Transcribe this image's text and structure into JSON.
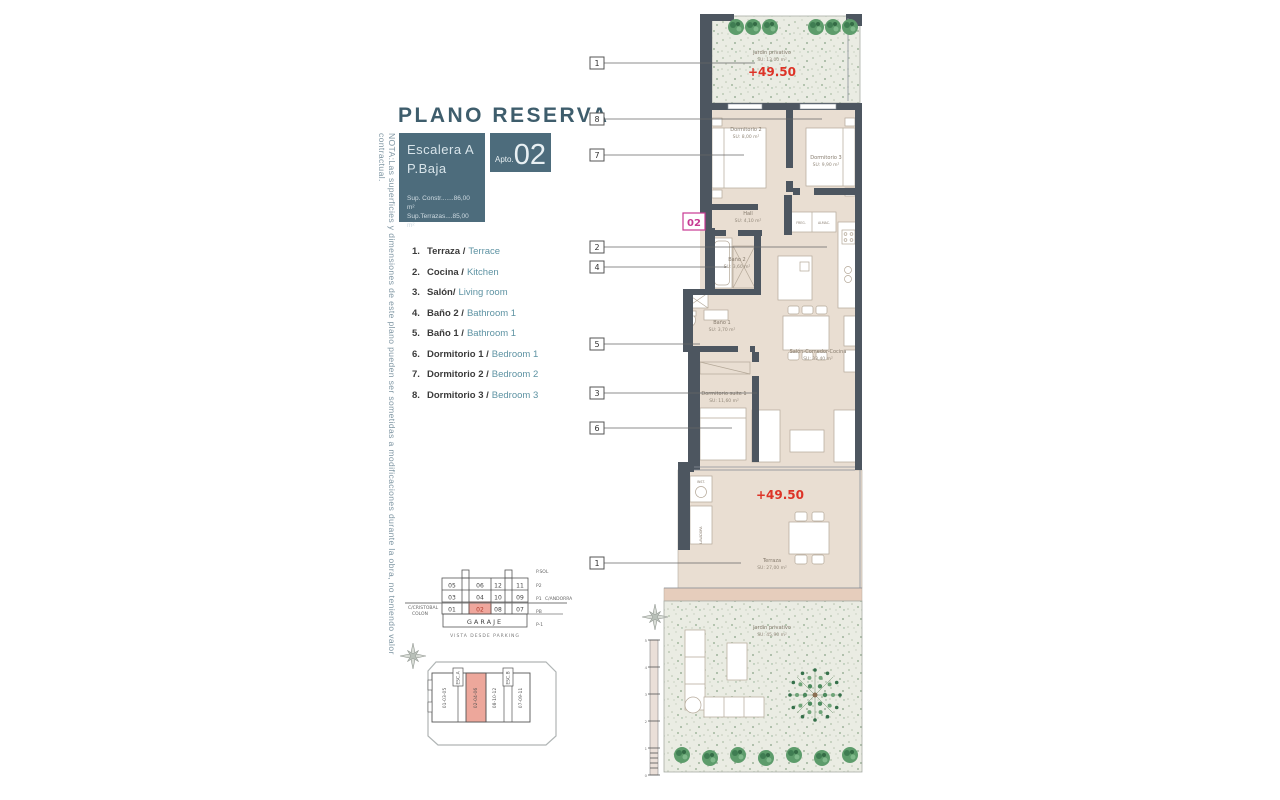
{
  "note": "NOTA:Las superficies y dimensiones de este plano pueden ser sometidas a modificaciones durante la obra, no teniendo valor contractual.",
  "header": {
    "title": "PLANO RESERVA",
    "escalera_line1": "Escalera A",
    "escalera_line2": "P.Baja",
    "sup_constr": "Sup. Constr.......86,00 m²",
    "sup_terrazas": "Sup.Terrazas....85,00 m²",
    "apto_prefix": "Apto.",
    "apto_number": "02"
  },
  "legend": {
    "items": [
      {
        "num": "1.",
        "es": "Terraza /",
        "en": "Terrace"
      },
      {
        "num": "2.",
        "es": "Cocina /",
        "en": "Kitchen"
      },
      {
        "num": "3.",
        "es": "Salón/",
        "en": "Living room"
      },
      {
        "num": "4.",
        "es": "Baño 2 /",
        "en": "Bathroom 1"
      },
      {
        "num": "5.",
        "es": "Baño 1 /",
        "en": "Bathroom 1"
      },
      {
        "num": "6.",
        "es": "Dormitorio 1 /",
        "en": "Bedroom 1"
      },
      {
        "num": "7.",
        "es": "Dormitorio 2 /",
        "en": "Bedroom 2"
      },
      {
        "num": "8.",
        "es": "Dormitorio 3 /",
        "en": "Bedroom 3"
      }
    ]
  },
  "keyplan": {
    "cells": [
      [
        "05",
        "06",
        "12",
        "11"
      ],
      [
        "03",
        "04",
        "10",
        "09"
      ],
      [
        "01",
        "02",
        "08",
        "07"
      ]
    ],
    "garage": "GARAJE",
    "floors": [
      "P.SOL",
      "P2",
      "P1",
      "PB",
      "P-1"
    ],
    "street_left_1": "C/CRISTOBAL",
    "street_left_2": "COLON",
    "street_right": "C/ANDORRA",
    "caption": "VISTA DESDE PARKING"
  },
  "siteplan": {
    "block1": "01-03-05",
    "esc_a": "ESC.A",
    "block2": "02-04-06",
    "block3": "08-10-12",
    "esc_b": "ESC.B",
    "block4": "07-09-11"
  },
  "plan": {
    "unit": "02",
    "level_top": "+49.50",
    "level_terrace": "+49.50",
    "callouts": [
      "1",
      "8",
      "7",
      "2",
      "4",
      "5",
      "3",
      "6",
      "1"
    ],
    "rooms": {
      "jardin_top_name": "Jardín privativo",
      "jardin_top_area": "SU: 13,00 m²",
      "dorm2_name": "Dormitorio 2",
      "dorm2_area": "SU: 8,00 m²",
      "dorm3_name": "Dormitorio 3",
      "dorm3_area": "SU: 9,90 m²",
      "hall_name": "Hall",
      "hall_area": "SU: 4,10 m²",
      "bano2_name": "Baño 2",
      "bano2_area": "SU: 3,60 m²",
      "bano1_name": "Baño 1",
      "bano1_area": "SU: 3,70 m²",
      "salon_name": "Salón-Comedor-Cocina",
      "salon_area": "SU: 33,40 m²",
      "suite_name": "Dormitorio suite 1",
      "suite_area": "SU: 11,60 m²",
      "terraza_name": "Terraza",
      "terraza_area": "SU: 27,00 m²",
      "jardin_bottom_name": "Jardín privativo",
      "jardin_bottom_area": "SU: 45,90 m²"
    },
    "tiny": {
      "freg": "FREG.",
      "almac": "ALMAC.",
      "inst": "INST.",
      "lavadora": "LAVADORA"
    },
    "scale_ticks": [
      "5",
      "4",
      "3",
      "2",
      "1",
      "0"
    ]
  },
  "colors": {
    "teal": "#4d6c7c",
    "accent_red": "#dd3327",
    "magenta": "#c73a92",
    "wall": "#4d5660",
    "floor": "#e9ded2",
    "highlight_pink": "#f0a79d"
  }
}
